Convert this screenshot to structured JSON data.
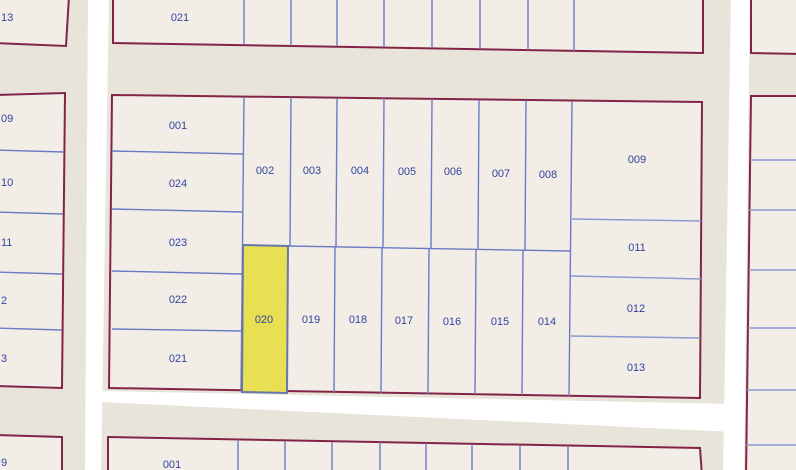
{
  "map": {
    "type": "cadastral-parcel-map",
    "highlighted_parcel": "020",
    "colors": {
      "background": "#e8e4da",
      "parcel_fill": "#f2eee7",
      "block_border": "#832347",
      "lot_line": "#6b7cc4",
      "label_text": "#33439e",
      "street": "#ffffff",
      "highlight_fill": "#e8e052",
      "highlight_border": "#6677a8"
    },
    "labels": {
      "top_left": "13",
      "top_strip": "021",
      "left_column": [
        "09",
        "10",
        "11",
        "2",
        "3"
      ],
      "main_left": [
        "001",
        "024",
        "023",
        "022",
        "021"
      ],
      "main_upper": [
        "002",
        "003",
        "004",
        "005",
        "006",
        "007",
        "008"
      ],
      "main_lower": [
        "020",
        "019",
        "018",
        "017",
        "016",
        "015",
        "014"
      ],
      "main_right": [
        "009",
        "011",
        "012",
        "013"
      ],
      "bottom_strip": "001",
      "bottom_left": "9"
    }
  }
}
